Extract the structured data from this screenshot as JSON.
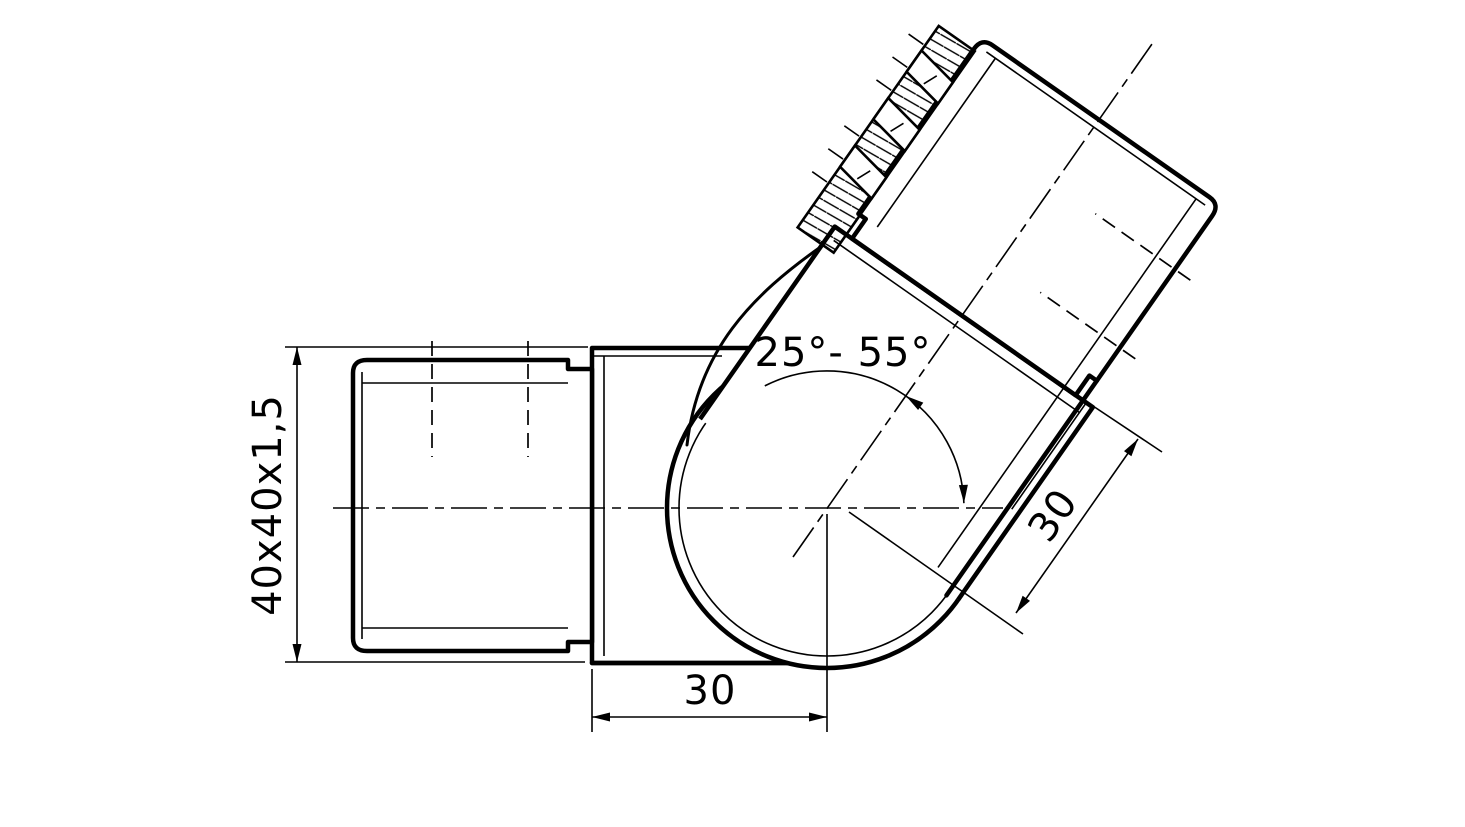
{
  "drawing": {
    "description": "Technical drawing of an adjustable-angle square tube connector with serrated joint",
    "colors": {
      "line": "#000000",
      "background": "#ffffff"
    },
    "dims": {
      "tube_section": "40x40x1,5",
      "angle_range": "25°- 55°",
      "depth_bottom": "30",
      "depth_angled": "30"
    }
  }
}
